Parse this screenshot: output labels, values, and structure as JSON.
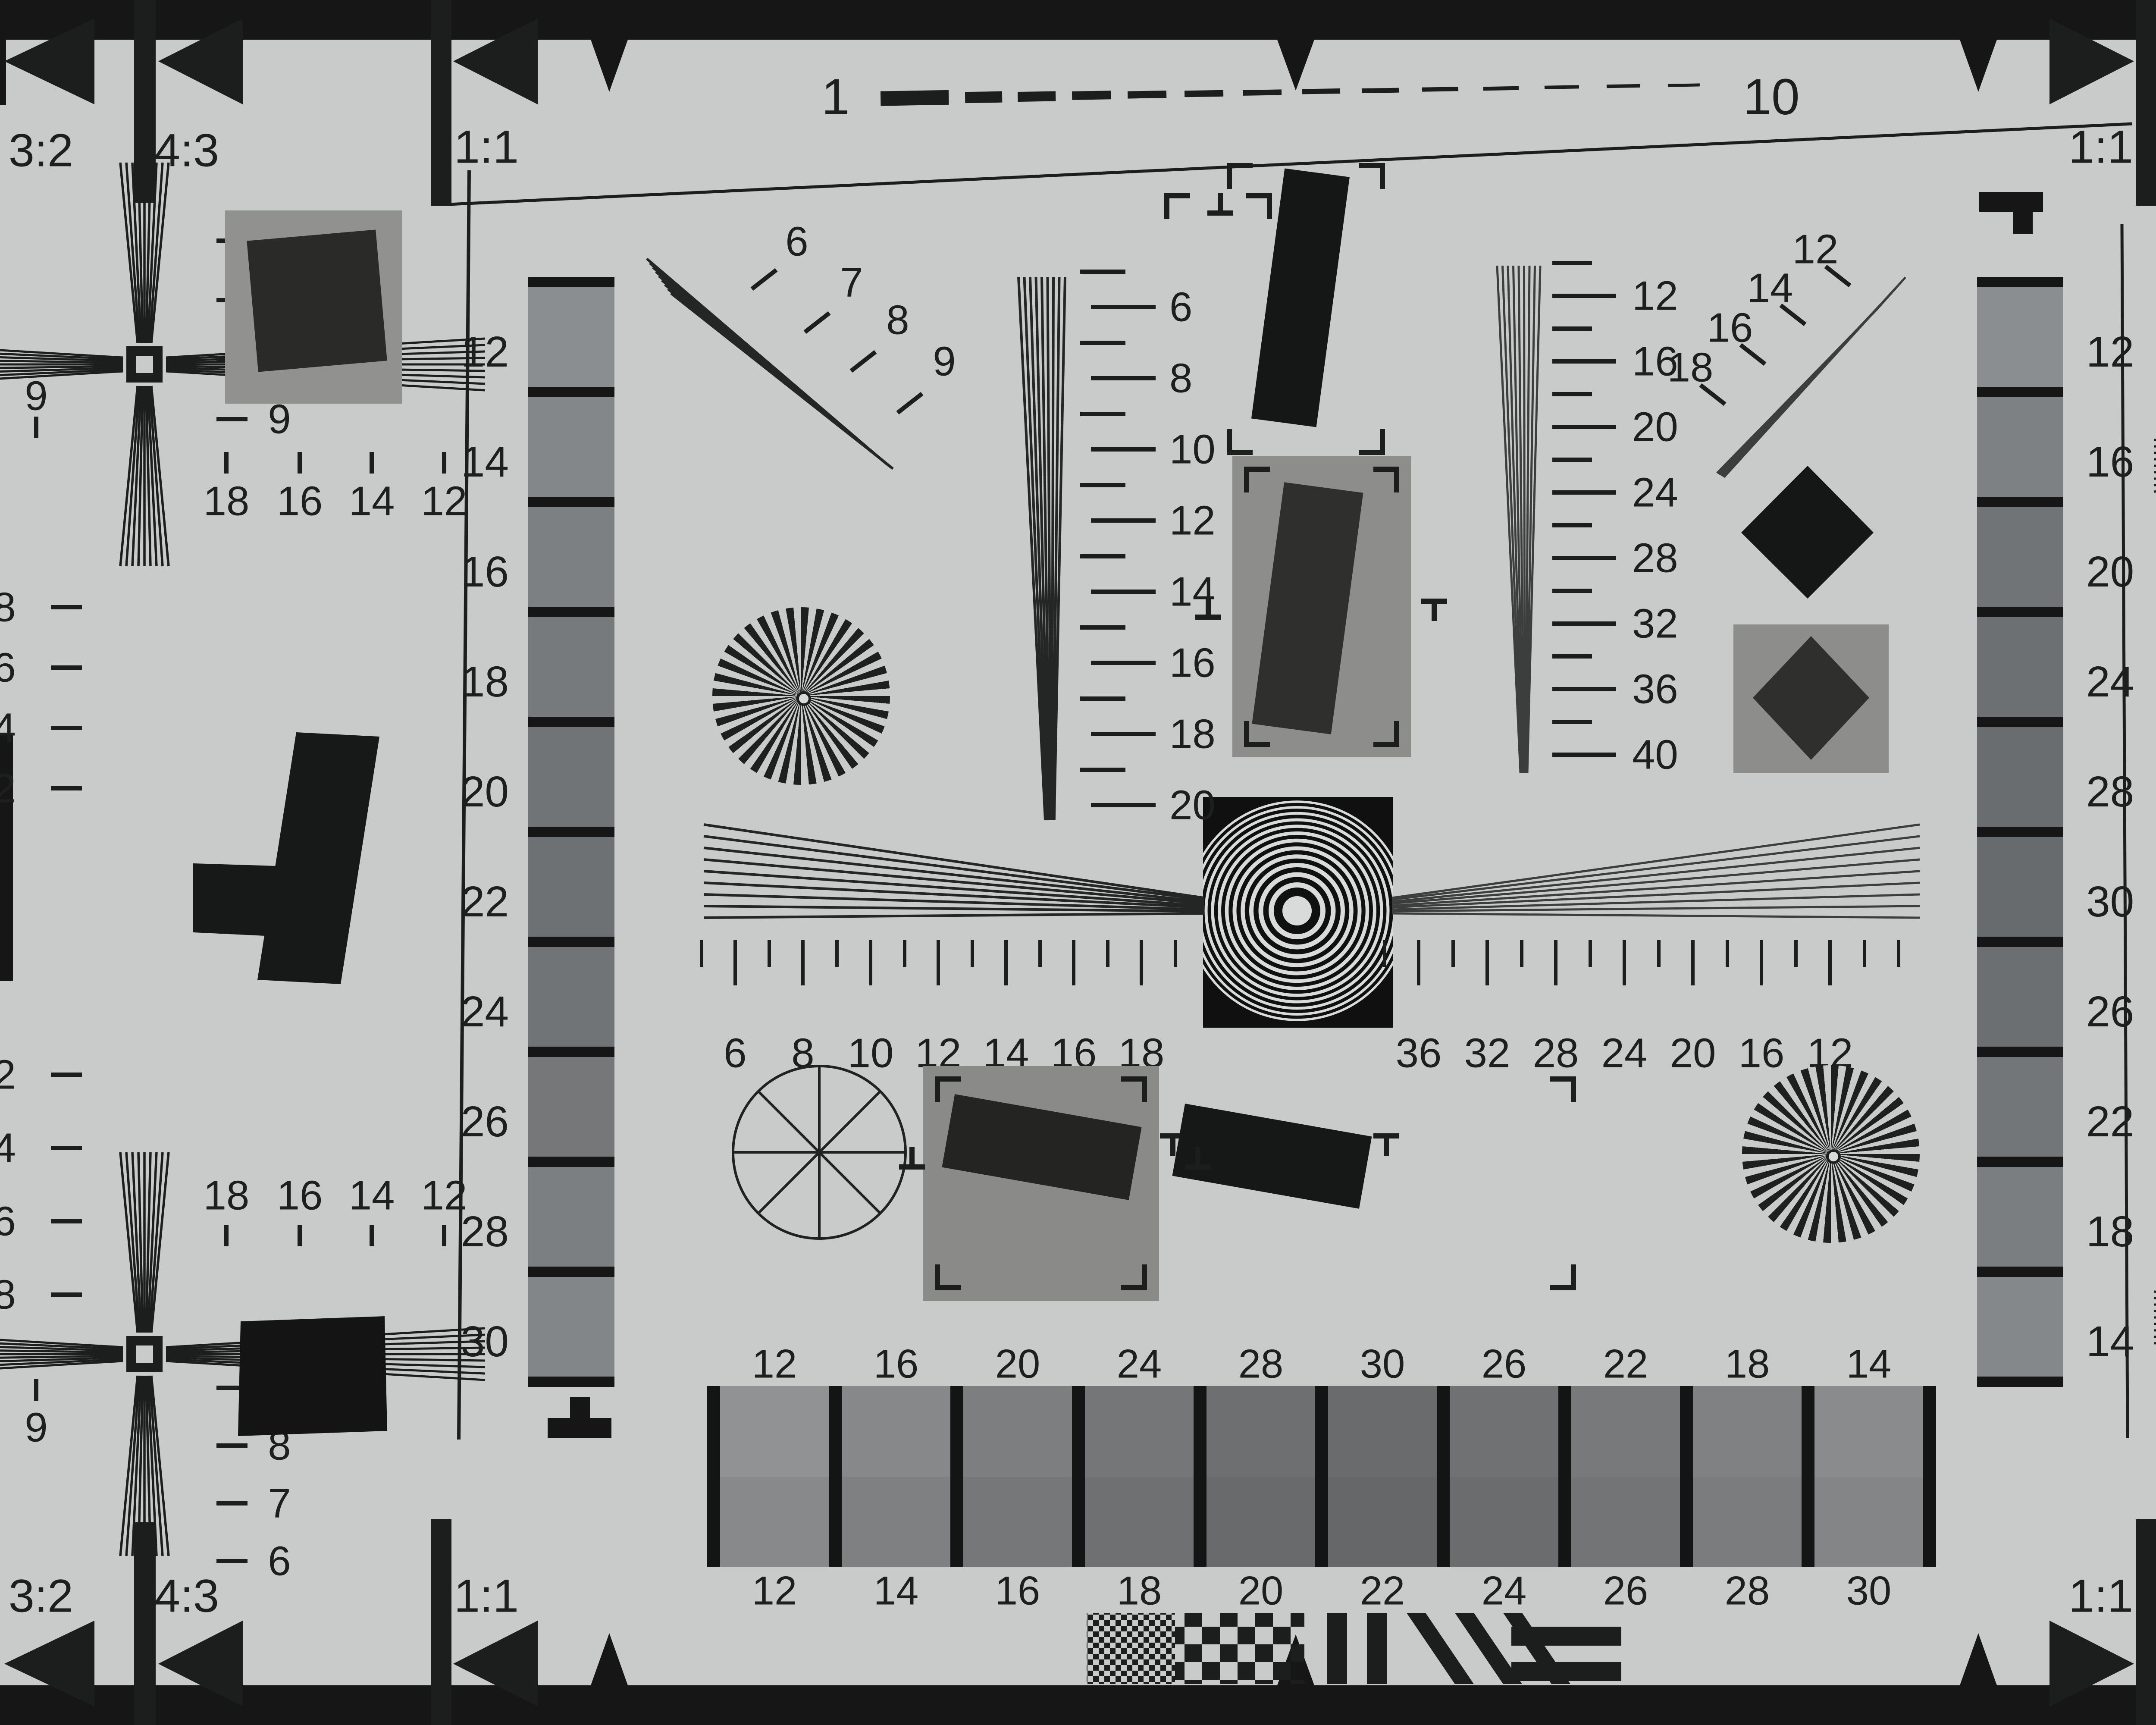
{
  "chart_title": "resolution-test-chart",
  "colors": {
    "paper": "#c9cbcb",
    "ink": "#1c1d1d",
    "panel_gray": "#8f8f8d",
    "dark_patch": "#2e2e2d",
    "zone_plate_black": "#101010",
    "zone_plate_white": "#d9dada"
  },
  "ruler": {
    "start": "1",
    "end": "10"
  },
  "aspect": {
    "tl": [
      "3:2",
      "4:3",
      "1:1"
    ],
    "tr": [
      "1:1",
      "4:3",
      "3:2"
    ],
    "bl": [
      "3:2",
      "4:3",
      "1:1"
    ],
    "br": [
      "1:1",
      "4:3",
      "3:2"
    ]
  },
  "strip_left": [
    "12",
    "14",
    "16",
    "18",
    "20",
    "22",
    "24",
    "26",
    "28",
    "30"
  ],
  "strip_right": [
    "12",
    "16",
    "20",
    "24",
    "28",
    "30",
    "26",
    "22",
    "18",
    "14"
  ],
  "vscale_left": [
    "6",
    "8",
    "10",
    "12",
    "14",
    "16",
    "18",
    "20"
  ],
  "vscale_right": [
    "12",
    "16",
    "20",
    "24",
    "28",
    "32",
    "36",
    "40"
  ],
  "hscale_left": [
    "6",
    "8",
    "10",
    "12",
    "14",
    "16",
    "18"
  ],
  "hscale_right": [
    "36",
    "32",
    "28",
    "24",
    "20",
    "16",
    "12"
  ],
  "fan_tl": [
    "6",
    "7",
    "8",
    "9"
  ],
  "fan_tr": [
    "12",
    "14",
    "16",
    "18"
  ],
  "cross_tl": {
    "rows": [
      "6",
      "7",
      "8",
      "9"
    ],
    "ticks": [
      "18",
      "16",
      "14",
      "12"
    ],
    "edge": "9"
  },
  "cross_bl": {
    "rows": [
      "9",
      "8",
      "7",
      "6"
    ],
    "ticks": [
      "18",
      "16",
      "14",
      "12"
    ],
    "edge": "9"
  },
  "cross_tr": {
    "rows": [
      "6",
      "7",
      "8",
      "9"
    ],
    "ticks": [
      "12",
      "14",
      "16",
      "18"
    ],
    "edge": "9"
  },
  "cross_br": {
    "rows": [
      "9",
      "8",
      "7",
      "6"
    ],
    "ticks": [
      "12",
      "14",
      "16",
      "18"
    ],
    "edge": "9"
  },
  "edge_left_top": [
    "8",
    "6",
    "4",
    "2"
  ],
  "edge_left_bottom": [
    "2",
    "4",
    "6",
    "8"
  ],
  "edge_right": [
    "1",
    "1",
    "1",
    "1"
  ],
  "bottom_strip": {
    "top": [
      "12",
      "16",
      "20",
      "24",
      "28",
      "30",
      "26",
      "22",
      "18",
      "14"
    ],
    "bottom": [
      "12",
      "14",
      "16",
      "18",
      "20",
      "22",
      "24",
      "26",
      "28",
      "30"
    ]
  }
}
